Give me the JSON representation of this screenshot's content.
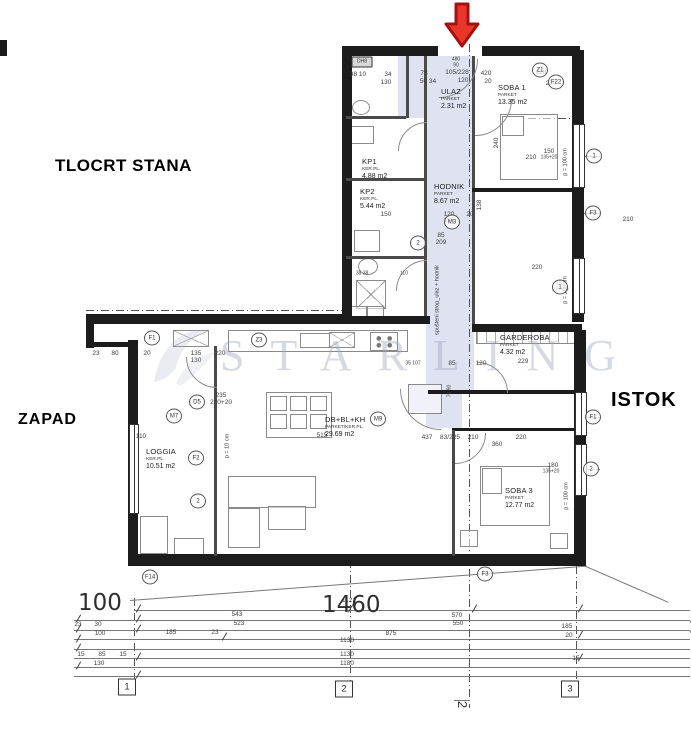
{
  "labels": {
    "plan_title": "TLOCRT STANA",
    "west": "ZAPAD",
    "east": "ISTOK"
  },
  "watermark": {
    "text": "STARLING"
  },
  "section": {
    "label": "2"
  },
  "bottom": {
    "total_left": "100",
    "total_main": "1460"
  },
  "colors": {
    "wall": "#1c1c1c",
    "hallway": "#dfe2f1",
    "arrow_fill": "#e8362a",
    "arrow_stroke": "#a31210",
    "watermark": "rgba(158,165,185,0.42)"
  },
  "plan": {
    "rooms": [
      {
        "name": "ULAZ",
        "material": "PARKET",
        "area": "2.31 m2",
        "x": 441,
        "y": 88
      },
      {
        "name": "SOBA 1",
        "material": "PARKET",
        "area": "13.35 m2",
        "x": 498,
        "y": 84
      },
      {
        "name": "KP1",
        "material": "KER.PL.",
        "area": "4.88 m2",
        "x": 362,
        "y": 158
      },
      {
        "name": "KP2",
        "material": "KER.PL.",
        "area": "5.44 m2",
        "x": 360,
        "y": 188
      },
      {
        "name": "HODNIK",
        "material": "PARKET",
        "area": "8.67 m2",
        "x": 434,
        "y": 183
      },
      {
        "name": "GARDEROBA",
        "material": "PARKET",
        "area": "4.32 m2",
        "x": 500,
        "y": 334
      },
      {
        "name": "LOGGIA",
        "material": "KER.PL.",
        "area": "10.51 m2",
        "x": 146,
        "y": 448
      },
      {
        "name": "DB+BL+KH",
        "material": "PARKET/KER.PL.",
        "area": "29.69 m2",
        "x": 325,
        "y": 416
      },
      {
        "name": "SOBA 3",
        "material": "PARKET",
        "area": "12.77 m2",
        "x": 505,
        "y": 487
      }
    ],
    "markers": [
      {
        "t": "DH8",
        "x": 362,
        "y": 62,
        "shape": "r"
      },
      {
        "t": "Z1",
        "x": 540,
        "y": 70
      },
      {
        "t": "F22",
        "x": 556,
        "y": 82
      },
      {
        "t": "1",
        "x": 594,
        "y": 156
      },
      {
        "t": "F3",
        "x": 593,
        "y": 213
      },
      {
        "t": "1",
        "x": 560,
        "y": 287
      },
      {
        "t": "2",
        "x": 418,
        "y": 243
      },
      {
        "t": "M3",
        "x": 452,
        "y": 222
      },
      {
        "t": "Z3",
        "x": 259,
        "y": 340
      },
      {
        "t": "F1",
        "x": 152,
        "y": 338
      },
      {
        "t": "D5",
        "x": 197,
        "y": 402
      },
      {
        "t": "M7",
        "x": 174,
        "y": 416
      },
      {
        "t": "M9",
        "x": 378,
        "y": 419
      },
      {
        "t": "F2",
        "x": 196,
        "y": 458
      },
      {
        "t": "2",
        "x": 198,
        "y": 501
      },
      {
        "t": "F1",
        "x": 593,
        "y": 417
      },
      {
        "t": "2",
        "x": 591,
        "y": 469
      },
      {
        "t": "F3",
        "x": 485,
        "y": 574
      },
      {
        "t": "F14",
        "x": 150,
        "y": 577
      },
      {
        "t": "1",
        "x": 127,
        "y": 687,
        "shape": "g"
      },
      {
        "t": "2",
        "x": 344,
        "y": 689,
        "shape": "g"
      },
      {
        "t": "3",
        "x": 570,
        "y": 689,
        "shape": "g"
      }
    ],
    "dims": [
      {
        "t": "38 10",
        "x": 358,
        "y": 75
      },
      {
        "t": "34",
        "x": 388,
        "y": 75
      },
      {
        "t": "130",
        "x": 386,
        "y": 83
      },
      {
        "t": "73",
        "x": 424,
        "y": 74
      },
      {
        "t": "50 34",
        "x": 428,
        "y": 82
      },
      {
        "t": "105/228",
        "x": 457,
        "y": 73
      },
      {
        "t": "120",
        "x": 463,
        "y": 81
      },
      {
        "t": "420",
        "x": 486,
        "y": 74
      },
      {
        "t": "20",
        "x": 488,
        "y": 82
      },
      {
        "t": "218",
        "x": 541,
        "y": 73
      },
      {
        "t": "230",
        "x": 551,
        "y": 84
      },
      {
        "t": "480",
        "x": 456,
        "y": 60,
        "s": 5
      },
      {
        "t": "90",
        "x": 456,
        "y": 66,
        "s": 5
      },
      {
        "t": "240",
        "x": 497,
        "y": 143,
        "r": -90
      },
      {
        "t": "210",
        "x": 531,
        "y": 158
      },
      {
        "t": "150",
        "x": 549,
        "y": 152
      },
      {
        "t": "135+20",
        "x": 549,
        "y": 158,
        "s": 5
      },
      {
        "t": "120",
        "x": 449,
        "y": 215
      },
      {
        "t": "196",
        "x": 449,
        "y": 221
      },
      {
        "t": "20",
        "x": 470,
        "y": 215
      },
      {
        "t": "138",
        "x": 480,
        "y": 205,
        "r": -90
      },
      {
        "t": "210",
        "x": 628,
        "y": 220
      },
      {
        "t": "220",
        "x": 537,
        "y": 268
      },
      {
        "t": "150",
        "x": 560,
        "y": 284,
        "s": 5
      },
      {
        "t": "135+20",
        "x": 560,
        "y": 290,
        "s": 5
      },
      {
        "t": "150",
        "x": 386,
        "y": 215
      },
      {
        "t": "85",
        "x": 441,
        "y": 236
      },
      {
        "t": "209",
        "x": 441,
        "y": 243
      },
      {
        "t": "38 38",
        "x": 362,
        "y": 274,
        "s": 5
      },
      {
        "t": "110",
        "x": 404,
        "y": 274,
        "s": 5
      },
      {
        "t": "23",
        "x": 96,
        "y": 354
      },
      {
        "t": "80",
        "x": 115,
        "y": 354
      },
      {
        "t": "20",
        "x": 147,
        "y": 354
      },
      {
        "t": "135",
        "x": 196,
        "y": 354
      },
      {
        "t": "130",
        "x": 196,
        "y": 361
      },
      {
        "t": "220",
        "x": 220,
        "y": 354
      },
      {
        "t": "35 107",
        "x": 413,
        "y": 364,
        "s": 5
      },
      {
        "t": "85",
        "x": 452,
        "y": 364
      },
      {
        "t": "120",
        "x": 481,
        "y": 364
      },
      {
        "t": "229",
        "x": 523,
        "y": 362
      },
      {
        "t": "235",
        "x": 221,
        "y": 396
      },
      {
        "t": "220+20",
        "x": 221,
        "y": 403
      },
      {
        "t": "515",
        "x": 322,
        "y": 436
      },
      {
        "t": "437",
        "x": 427,
        "y": 438
      },
      {
        "t": "83/225",
        "x": 450,
        "y": 438
      },
      {
        "t": "210",
        "x": 473,
        "y": 438
      },
      {
        "t": "360",
        "x": 497,
        "y": 445
      },
      {
        "t": "220",
        "x": 521,
        "y": 438
      },
      {
        "t": "70 90",
        "x": 450,
        "y": 391,
        "r": -90,
        "s": 5
      },
      {
        "t": "180",
        "x": 553,
        "y": 466
      },
      {
        "t": "135+20",
        "x": 551,
        "y": 472,
        "s": 5
      },
      {
        "t": "110",
        "x": 141,
        "y": 437
      },
      {
        "t": "1121",
        "x": 349,
        "y": 601
      },
      {
        "t": "543",
        "x": 237,
        "y": 615
      },
      {
        "t": "570",
        "x": 457,
        "y": 616
      },
      {
        "t": "523",
        "x": 239,
        "y": 624
      },
      {
        "t": "550",
        "x": 458,
        "y": 624
      },
      {
        "t": "23",
        "x": 78,
        "y": 625
      },
      {
        "t": "30",
        "x": 98,
        "y": 625
      },
      {
        "t": "185",
        "x": 171,
        "y": 633
      },
      {
        "t": "23",
        "x": 215,
        "y": 633
      },
      {
        "t": "100",
        "x": 100,
        "y": 634
      },
      {
        "t": "875",
        "x": 391,
        "y": 634
      },
      {
        "t": "185",
        "x": 567,
        "y": 627
      },
      {
        "t": "20",
        "x": 569,
        "y": 636
      },
      {
        "t": "15",
        "x": 81,
        "y": 655
      },
      {
        "t": "85",
        "x": 102,
        "y": 655
      },
      {
        "t": "15",
        "x": 123,
        "y": 655
      },
      {
        "t": "1130",
        "x": 347,
        "y": 641
      },
      {
        "t": "1130",
        "x": 347,
        "y": 655
      },
      {
        "t": "1180",
        "x": 347,
        "y": 664
      },
      {
        "t": "130",
        "x": 99,
        "y": 664
      },
      {
        "t": "15",
        "x": 576,
        "y": 659
      }
    ],
    "vtexts": [
      {
        "t": "spušteni strop_ulaz + hodnik",
        "x": 438,
        "y": 300
      },
      {
        "t": "p = 100 cm",
        "x": 566,
        "y": 162
      },
      {
        "t": "p = 100 cm",
        "x": 566,
        "y": 290
      },
      {
        "t": "p = 100 cm",
        "x": 567,
        "y": 496
      },
      {
        "t": "p = 10 cm",
        "x": 228,
        "y": 446
      }
    ],
    "tints": [
      {
        "x": 426,
        "y": 56,
        "w": 48,
        "h": 338
      },
      {
        "x": 426,
        "y": 394,
        "w": 36,
        "h": 34
      },
      {
        "x": 398,
        "y": 56,
        "w": 28,
        "h": 62
      },
      {
        "x": 408,
        "y": 384,
        "w": 34,
        "h": 28
      }
    ],
    "walls": [
      {
        "x": 342,
        "y": 46,
        "w": 10,
        "h": 278
      },
      {
        "x": 342,
        "y": 46,
        "w": 96,
        "h": 10
      },
      {
        "x": 482,
        "y": 46,
        "w": 98,
        "h": 10
      },
      {
        "x": 572,
        "y": 50,
        "w": 12,
        "h": 272
      },
      {
        "x": 424,
        "y": 56,
        "w": 3,
        "h": 260,
        "cls": "t"
      },
      {
        "x": 472,
        "y": 56,
        "w": 3,
        "h": 134,
        "cls": "t"
      },
      {
        "x": 472,
        "y": 188,
        "w": 108,
        "h": 4
      },
      {
        "x": 472,
        "y": 192,
        "w": 3,
        "h": 136,
        "cls": "t"
      },
      {
        "x": 472,
        "y": 324,
        "w": 110,
        "h": 8
      },
      {
        "x": 428,
        "y": 390,
        "w": 154,
        "h": 4
      },
      {
        "x": 86,
        "y": 314,
        "w": 262,
        "h": 10
      },
      {
        "x": 342,
        "y": 316,
        "w": 88,
        "h": 8
      },
      {
        "x": 86,
        "y": 314,
        "w": 8,
        "h": 34
      },
      {
        "x": 86,
        "y": 342,
        "w": 46,
        "h": 5
      },
      {
        "x": 128,
        "y": 340,
        "w": 10,
        "h": 222
      },
      {
        "x": 128,
        "y": 554,
        "w": 458,
        "h": 12
      },
      {
        "x": 574,
        "y": 330,
        "w": 12,
        "h": 228
      },
      {
        "x": 214,
        "y": 346,
        "w": 3,
        "h": 210,
        "cls": "t"
      },
      {
        "x": 452,
        "y": 428,
        "w": 130,
        "h": 3
      },
      {
        "x": 452,
        "y": 430,
        "w": 3,
        "h": 126,
        "cls": "t"
      },
      {
        "x": 406,
        "y": 56,
        "w": 3,
        "h": 62,
        "cls": "t"
      },
      {
        "x": 346,
        "y": 116,
        "w": 60,
        "h": 3,
        "cls": "t"
      },
      {
        "x": 346,
        "y": 178,
        "w": 80,
        "h": 3,
        "cls": "t"
      },
      {
        "x": 346,
        "y": 256,
        "w": 80,
        "h": 3,
        "cls": "t"
      },
      {
        "x": 0,
        "y": 40,
        "w": 7,
        "h": 16
      }
    ],
    "windows": [
      {
        "x": 573,
        "y": 124,
        "w": 10,
        "h": 62
      },
      {
        "x": 573,
        "y": 258,
        "w": 10,
        "h": 54
      },
      {
        "x": 575,
        "y": 392,
        "w": 10,
        "h": 42
      },
      {
        "x": 575,
        "y": 444,
        "w": 10,
        "h": 50
      },
      {
        "x": 129,
        "y": 424,
        "w": 8,
        "h": 88
      }
    ],
    "furniture": [
      {
        "x": 228,
        "y": 330,
        "w": 178,
        "h": 20
      },
      {
        "x": 300,
        "y": 333,
        "w": 28,
        "h": 13
      },
      {
        "x": 370,
        "y": 332,
        "w": 26,
        "h": 17,
        "cls": "st"
      },
      {
        "x": 173,
        "y": 330,
        "w": 34,
        "h": 15,
        "cls": "x"
      },
      {
        "x": 329,
        "y": 332,
        "w": 24,
        "h": 14,
        "cls": "x"
      },
      {
        "x": 266,
        "y": 392,
        "w": 64,
        "h": 44
      },
      {
        "x": 270,
        "y": 396,
        "w": 15,
        "h": 13
      },
      {
        "x": 290,
        "y": 396,
        "w": 15,
        "h": 13
      },
      {
        "x": 310,
        "y": 396,
        "w": 15,
        "h": 13
      },
      {
        "x": 270,
        "y": 414,
        "w": 15,
        "h": 13
      },
      {
        "x": 290,
        "y": 414,
        "w": 15,
        "h": 13
      },
      {
        "x": 310,
        "y": 414,
        "w": 15,
        "h": 13
      },
      {
        "x": 228,
        "y": 476,
        "w": 86,
        "h": 30
      },
      {
        "x": 228,
        "y": 508,
        "w": 30,
        "h": 38
      },
      {
        "x": 268,
        "y": 506,
        "w": 36,
        "h": 22
      },
      {
        "x": 140,
        "y": 516,
        "w": 26,
        "h": 36
      },
      {
        "x": 174,
        "y": 538,
        "w": 28,
        "h": 16
      },
      {
        "x": 480,
        "y": 466,
        "w": 68,
        "h": 58
      },
      {
        "x": 482,
        "y": 468,
        "w": 18,
        "h": 24
      },
      {
        "x": 460,
        "y": 530,
        "w": 16,
        "h": 15
      },
      {
        "x": 550,
        "y": 533,
        "w": 16,
        "h": 14
      },
      {
        "x": 500,
        "y": 114,
        "w": 56,
        "h": 64
      },
      {
        "x": 502,
        "y": 116,
        "w": 20,
        "h": 18
      },
      {
        "x": 476,
        "y": 330,
        "w": 102,
        "h": 12,
        "cls": "h"
      },
      {
        "x": 408,
        "y": 384,
        "w": 32,
        "h": 28
      },
      {
        "x": 354,
        "y": 230,
        "w": 24,
        "h": 20
      },
      {
        "x": 358,
        "y": 258,
        "w": 18,
        "h": 15,
        "cls": "e"
      },
      {
        "x": 356,
        "y": 280,
        "w": 28,
        "h": 27,
        "cls": "x"
      },
      {
        "x": 350,
        "y": 306,
        "w": 15,
        "h": 13
      },
      {
        "x": 367,
        "y": 306,
        "w": 15,
        "h": 13
      },
      {
        "x": 350,
        "y": 126,
        "w": 22,
        "h": 16
      },
      {
        "x": 352,
        "y": 100,
        "w": 16,
        "h": 13,
        "cls": "e"
      }
    ],
    "arcs": [
      {
        "x": 400,
        "y": 20,
        "d": 76,
        "r": 90
      },
      {
        "x": 438,
        "y": 62,
        "d": 72,
        "r": 90
      },
      {
        "x": 398,
        "y": 122,
        "d": 56,
        "r": 270
      },
      {
        "x": 396,
        "y": 260,
        "d": 60,
        "r": 270
      },
      {
        "x": 400,
        "y": 348,
        "d": 80,
        "r": 180
      },
      {
        "x": 446,
        "y": 362,
        "d": 60,
        "r": 0
      },
      {
        "x": 424,
        "y": 402,
        "d": 60,
        "r": 90
      },
      {
        "x": 186,
        "y": 326,
        "d": 60,
        "r": 180
      }
    ],
    "lines": [
      {
        "x": 469,
        "y": 44,
        "len": 664,
        "vert": true,
        "cls": "dd"
      },
      {
        "x": 86,
        "y": 310,
        "len": 262,
        "cls": "dd"
      },
      {
        "x": 528,
        "y": 118,
        "len": 48,
        "cls": "dd"
      },
      {
        "x": 134,
        "y": 598,
        "len": 92,
        "vert": true,
        "cls": "dd"
      },
      {
        "x": 350,
        "y": 560,
        "len": 130,
        "vert": true,
        "cls": "dd"
      },
      {
        "x": 576,
        "y": 566,
        "len": 124,
        "vert": true,
        "cls": "dd"
      },
      {
        "x": 584,
        "y": 156,
        "len": 16
      },
      {
        "x": 584,
        "y": 213,
        "len": 16
      },
      {
        "x": 584,
        "y": 417,
        "len": 16
      },
      {
        "x": 584,
        "y": 469,
        "len": 16
      },
      {
        "x": 134,
        "y": 610,
        "len": 556
      },
      {
        "x": 74,
        "y": 620,
        "len": 616
      },
      {
        "x": 74,
        "y": 630,
        "len": 616
      },
      {
        "x": 74,
        "y": 639,
        "len": 616
      },
      {
        "x": 74,
        "y": 649,
        "len": 616
      },
      {
        "x": 74,
        "y": 658,
        "len": 616
      },
      {
        "x": 74,
        "y": 667,
        "len": 616
      },
      {
        "x": 74,
        "y": 676,
        "len": 616
      },
      {
        "x": 454,
        "y": 700,
        "len": 16
      },
      {
        "x": 130,
        "y": 600,
        "len": 458,
        "rot": -4.3
      },
      {
        "x": 586,
        "y": 566,
        "len": 90,
        "rot": 23.5
      }
    ],
    "ticks": [
      {
        "x": 134,
        "y": 608
      },
      {
        "x": 346,
        "y": 608
      },
      {
        "x": 576,
        "y": 608
      },
      {
        "x": 470,
        "y": 608
      },
      {
        "x": 74,
        "y": 618
      },
      {
        "x": 134,
        "y": 618
      },
      {
        "x": 688,
        "y": 618
      },
      {
        "x": 74,
        "y": 628
      },
      {
        "x": 134,
        "y": 628
      },
      {
        "x": 688,
        "y": 628
      },
      {
        "x": 220,
        "y": 636
      },
      {
        "x": 74,
        "y": 638
      },
      {
        "x": 74,
        "y": 647
      },
      {
        "x": 134,
        "y": 656
      },
      {
        "x": 74,
        "y": 665
      },
      {
        "x": 134,
        "y": 674
      },
      {
        "x": 576,
        "y": 634
      },
      {
        "x": 576,
        "y": 657
      }
    ]
  }
}
